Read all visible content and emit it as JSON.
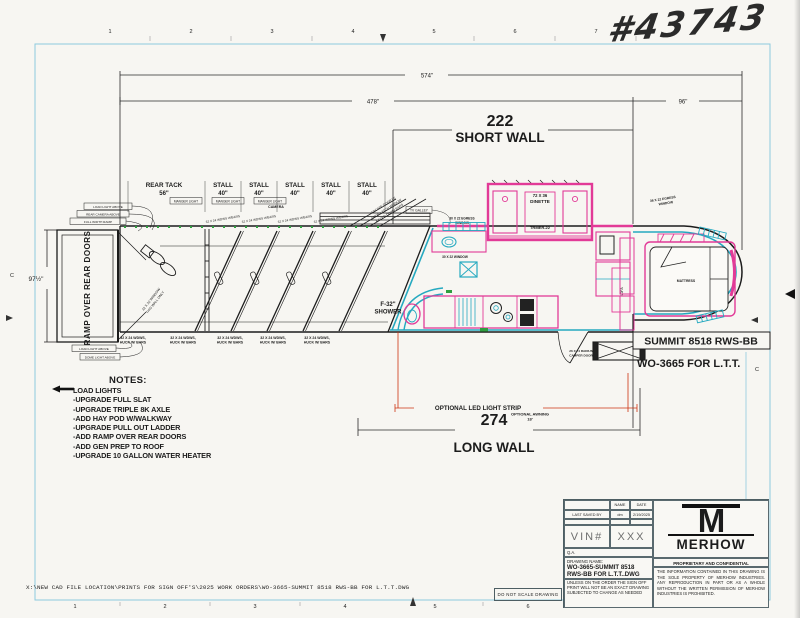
{
  "colors": {
    "pink": "#e23a97",
    "cyan": "#25a9c0",
    "red": "#cc3311",
    "frame_blue": "#8ecbdf",
    "green": "#2f9e3f"
  },
  "meta": {
    "handwritten_number": "#43743"
  },
  "frame": {
    "top_ruler": [
      "1",
      "2",
      "3",
      "4",
      "5",
      "6",
      "7",
      "8"
    ],
    "bottom_ruler": [
      "1",
      "2",
      "3",
      "4",
      "5",
      "6",
      "7",
      "8"
    ],
    "left_letter": "C",
    "right_letter_c": "C",
    "right_letter_a": "A"
  },
  "dims": {
    "overall": "574\"",
    "rear_section": "478\"",
    "gooseneck": "96\"",
    "short_wall_value": "222",
    "short_wall_label": "SHORT WALL",
    "long_wall_value": "274",
    "long_wall_label": "LONG WALL",
    "body_height": "97½\""
  },
  "horse_area": {
    "ramp_label": "RAMP OVER REAR DOORS",
    "rear_tack_label": "REAR TACK",
    "rear_tack_width": "56\"",
    "stall_label": "STALL",
    "stall_width": "40\"",
    "window_drop_line1": "32 X 24 WDWS,",
    "window_drop_line2": "HUCK W/ BARS",
    "window_top_label": "32 X 24 WDWS W/BARS",
    "manger_light_label": "MANGER LIGHT",
    "camera_label": "CAMERA",
    "tack_note_line1": "32 X 32 WINDOW",
    "tack_note_line2": "THIS WALL ONLY",
    "escape_line1": "ESCAPE DOOR W/",
    "escape_line2": "DROP LATCH WINDOW",
    "escape_line3": "& FOLD DOWN BARS",
    "callout_top_1": "LOAD LIGHT ABOVE",
    "callout_top_2": "REAR CAMERA ABOVE",
    "callout_top_3": "FULL WIDTH RAMP",
    "callout_bottom_1": "LOAD LIGHT ABOVE",
    "callout_bottom_2": "DOME LIGHT ABOVE"
  },
  "lq": {
    "shower_line1": "F-32\"",
    "shower_line2": "SHOWER",
    "dinette_size": "72 X 36",
    "dinette_label": "DINETTE",
    "dinette_model": "TRMER-22",
    "tv_label": "TV GALLEY",
    "egress_window_1a": "30 X 22 EGRESS",
    "egress_window_1b": "WINDOW",
    "window_2": "30 X 22 WINDOW",
    "sofa_label": "SOFA",
    "camper_door_line1": "26 X 74 RADIUS",
    "camper_door_line2": "CAMPER DOOR",
    "led_strip": "OPTIONAL LED LIGHT STRIP",
    "awning_line1": "OPTIONAL AWNING",
    "awning_line2": "18'"
  },
  "gooseneck": {
    "mattress": "MATTRESS",
    "top_window_a": "36 X 22 EGRESS",
    "top_window_b": "WINDOW",
    "bottom_window": "36 X 30 WINDOW",
    "model_box": "SUMMIT 8518 RWS-BB",
    "work_order": "WO-3665 FOR L.T.T."
  },
  "notes": {
    "title": "NOTES:",
    "items": [
      "LOAD LIGHTS",
      "-UPGRADE FULL SLAT",
      "-UPGRADE TRIPLE 8K AXLE",
      "-ADD HAY POD W/WALKWAY",
      "-UPGRADE PULL OUT LADDER",
      "-ADD RAMP OVER REAR DOORS",
      "-ADD GEN PREP TO ROOF",
      "-UPGRADE 10 GALLON WATER HEATER"
    ]
  },
  "title_block": {
    "name_header": "NAME",
    "date_header": "DATE",
    "last_saved_label": "LAST SAVED BY",
    "last_saved_name": "dm",
    "last_saved_date": "2/19/2025",
    "vin_label": "VIN#",
    "vin_value": "XXX",
    "qa_label": "Q.A.",
    "drawing_name_label": "DRAWING NAME:",
    "drawing_name_line1": "WO-3665-SUMMIT 8518",
    "drawing_name_line2": "RWS-BB FOR L.T.T..DWG",
    "disclaimer": "UNLESS ON THE ORDER THE SIGN OFF PRINT WILL NOT BE AN EXACT DRAWING SUBJECTED TO CHANGE AS NEEDED",
    "brand": "MERHOW",
    "proprietary_title": "PROPRIETARY AND CONFIDENTIAL",
    "proprietary_body": "THE INFORMATION CONTAINED IN THIS DRAWING IS THE SOLE PROPERTY OF MERHOW INDUSTRIES.  ANY REPRODUCTION IN PART OR AS A WHOLE WITHOUT THE WRITTEN PERMISSION OF MERHOW INDUSTRIES IS PROHIBITED.",
    "do_not_scale": "DO NOT SCALE DRAWING"
  },
  "footer": {
    "file_path": "X:\\NEW CAD FILE LOCATION\\PRINTS FOR SIGN OFF'S\\2025 WORK ORDERS\\WO-3665-SUMMIT 8518 RWS-BB FOR L.T.T.DWG"
  }
}
